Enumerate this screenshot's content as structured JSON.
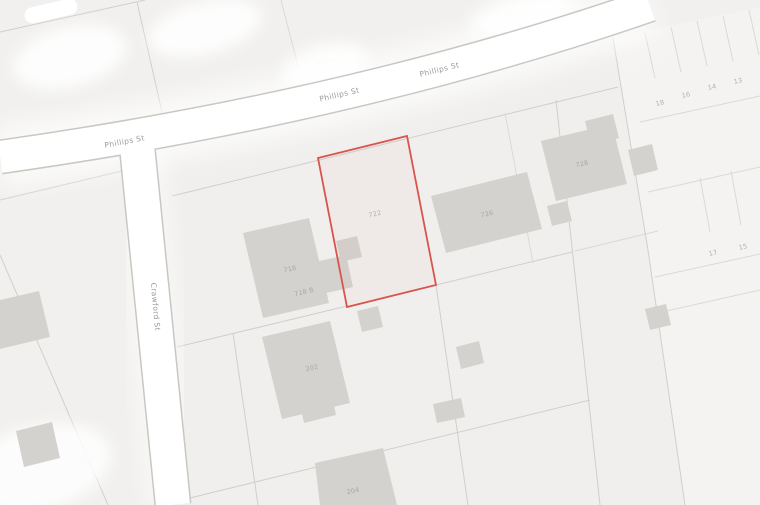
{
  "map_view": {
    "streets": {
      "phillips": "Phillips St",
      "crawford": "Crawford St"
    },
    "selected_parcel": {
      "number": "722",
      "outline_color": "#d9544d"
    },
    "building_labels": {
      "b718": "718",
      "b718b": "718 B",
      "b726": "726",
      "b728": "728",
      "b202": "202",
      "b204": "204"
    },
    "lot_numbers": {
      "l1": "18",
      "l2": "16",
      "l3": "14",
      "l4": "13",
      "l5": "17",
      "l6": "15"
    },
    "colors": {
      "background": "#f1f0ee",
      "road": "#ffffff",
      "road_edge": "#c9c7c2",
      "parcel_line": "#d1cfca",
      "building": "#d3d2cf",
      "selected": "#d9544d",
      "street_label": "#9d9b97",
      "number_label": "#b2b0ac"
    }
  }
}
